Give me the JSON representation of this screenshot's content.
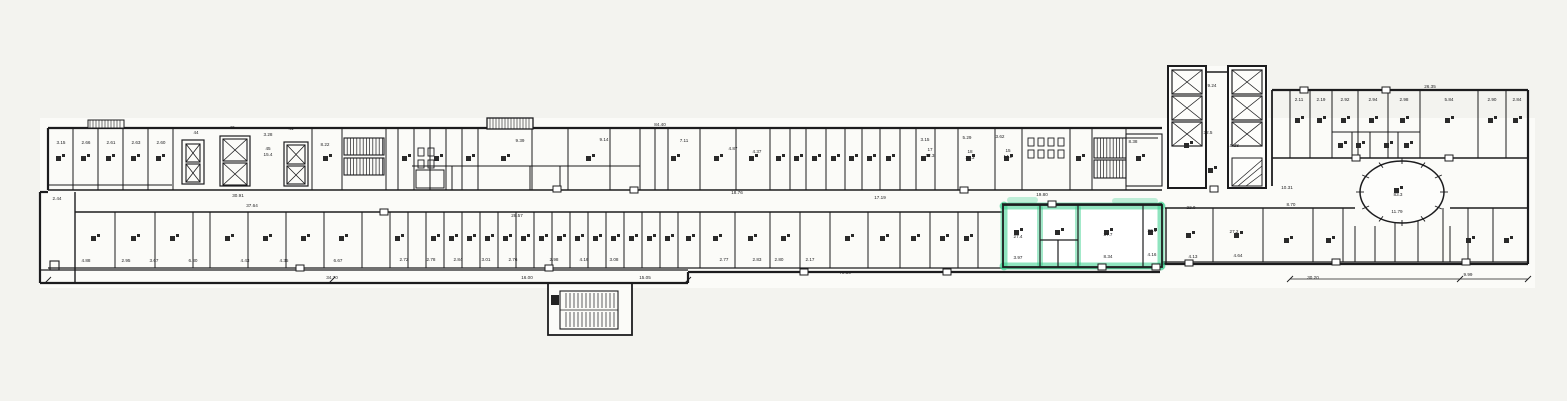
{
  "title": {
    "floor": "2 этаж",
    "address": "Правды ул., д.24, стр.4"
  },
  "highlight_color": "#35cf8c",
  "ink_color": "#1c1c1e",
  "labels": [
    {
      "t": "2.44",
      "x": 57,
      "y": 200
    },
    {
      "t": "3.15",
      "x": 61,
      "y": 144
    },
    {
      "t": "2.66",
      "x": 86,
      "y": 144
    },
    {
      "t": "2.61",
      "x": 111,
      "y": 144
    },
    {
      "t": "2.63",
      "x": 136,
      "y": 144
    },
    {
      "t": "2.60",
      "x": 161,
      "y": 144
    },
    {
      "t": "44",
      "x": 196,
      "y": 134
    },
    {
      "t": "42",
      "x": 232,
      "y": 129
    },
    {
      "t": "3.28",
      "x": 268,
      "y": 136
    },
    {
      "t": "41",
      "x": 291,
      "y": 130
    },
    {
      "t": "45",
      "x": 268,
      "y": 150
    },
    {
      "t": "15.4",
      "x": 268,
      "y": 156
    },
    {
      "t": "8.22",
      "x": 325,
      "y": 146
    },
    {
      "t": "30.91",
      "x": 238,
      "y": 197
    },
    {
      "t": "37.64",
      "x": 252,
      "y": 207
    },
    {
      "t": "9.39",
      "x": 520,
      "y": 142
    },
    {
      "t": "9.14",
      "x": 604,
      "y": 141
    },
    {
      "t": "7.11",
      "x": 684,
      "y": 142
    },
    {
      "t": "4.87",
      "x": 733,
      "y": 150
    },
    {
      "t": "4.37",
      "x": 757,
      "y": 153
    },
    {
      "t": "84.40",
      "x": 660,
      "y": 126
    },
    {
      "t": "3.15",
      "x": 925,
      "y": 141
    },
    {
      "t": "5.29",
      "x": 967,
      "y": 139
    },
    {
      "t": "3.62",
      "x": 1000,
      "y": 138
    },
    {
      "t": "17",
      "x": 930,
      "y": 151
    },
    {
      "t": "12.3",
      "x": 930,
      "y": 157
    },
    {
      "t": "18",
      "x": 970,
      "y": 153
    },
    {
      "t": "20.3",
      "x": 970,
      "y": 159
    },
    {
      "t": "15",
      "x": 1008,
      "y": 152
    },
    {
      "t": "14.2",
      "x": 1008,
      "y": 158
    },
    {
      "t": "8.38",
      "x": 1133,
      "y": 143
    },
    {
      "t": "28.57",
      "x": 517,
      "y": 217
    },
    {
      "t": "18.76",
      "x": 737,
      "y": 194
    },
    {
      "t": "17.19",
      "x": 880,
      "y": 199
    },
    {
      "t": "19.80",
      "x": 1042,
      "y": 196
    },
    {
      "t": "9.24",
      "x": 1212,
      "y": 87
    },
    {
      "t": "32.5",
      "x": 1208,
      "y": 134
    },
    {
      "t": "10.38",
      "x": 1233,
      "y": 147
    },
    {
      "t": "26.35",
      "x": 1430,
      "y": 88
    },
    {
      "t": "2.11",
      "x": 1299,
      "y": 101
    },
    {
      "t": "2.19",
      "x": 1321,
      "y": 101
    },
    {
      "t": "2.92",
      "x": 1345,
      "y": 101
    },
    {
      "t": "2.94",
      "x": 1373,
      "y": 101
    },
    {
      "t": "2.98",
      "x": 1404,
      "y": 101
    },
    {
      "t": "5.84",
      "x": 1449,
      "y": 101
    },
    {
      "t": "2.90",
      "x": 1492,
      "y": 101
    },
    {
      "t": "2.84",
      "x": 1517,
      "y": 101
    },
    {
      "t": "10.31",
      "x": 1287,
      "y": 189
    },
    {
      "t": "8.70",
      "x": 1291,
      "y": 206
    },
    {
      "t": "83.3",
      "x": 1398,
      "y": 196
    },
    {
      "t": "11.79",
      "x": 1397,
      "y": 213
    },
    {
      "t": "27.4",
      "x": 1018,
      "y": 238
    },
    {
      "t": "37.7",
      "x": 1108,
      "y": 236
    },
    {
      "t": "22.1",
      "x": 1152,
      "y": 232
    },
    {
      "t": "3.97",
      "x": 1018,
      "y": 259
    },
    {
      "t": "8.34",
      "x": 1108,
      "y": 258
    },
    {
      "t": "4.16",
      "x": 1152,
      "y": 256
    },
    {
      "t": "22.0",
      "x": 1191,
      "y": 209
    },
    {
      "t": "27.2",
      "x": 1234,
      "y": 233
    },
    {
      "t": "4.13",
      "x": 1193,
      "y": 258
    },
    {
      "t": "4.64",
      "x": 1238,
      "y": 257
    },
    {
      "t": "4.88",
      "x": 86,
      "y": 262
    },
    {
      "t": "2.95",
      "x": 126,
      "y": 262
    },
    {
      "t": "3.67",
      "x": 154,
      "y": 262
    },
    {
      "t": "6.80",
      "x": 193,
      "y": 262
    },
    {
      "t": "4.43",
      "x": 245,
      "y": 262
    },
    {
      "t": "4.35",
      "x": 284,
      "y": 262
    },
    {
      "t": "6.67",
      "x": 338,
      "y": 262
    },
    {
      "t": "2.72",
      "x": 404,
      "y": 261
    },
    {
      "t": "2.78",
      "x": 431,
      "y": 261
    },
    {
      "t": "2.84",
      "x": 458,
      "y": 261
    },
    {
      "t": "3.01",
      "x": 486,
      "y": 261
    },
    {
      "t": "2.76",
      "x": 513,
      "y": 261
    },
    {
      "t": "2.98",
      "x": 554,
      "y": 261
    },
    {
      "t": "4.16",
      "x": 584,
      "y": 261
    },
    {
      "t": "3.08",
      "x": 614,
      "y": 261
    },
    {
      "t": "2.77",
      "x": 724,
      "y": 261
    },
    {
      "t": "2.83",
      "x": 757,
      "y": 261
    },
    {
      "t": "2.80",
      "x": 779,
      "y": 261
    },
    {
      "t": "2.17",
      "x": 810,
      "y": 261
    },
    {
      "t": "34.70",
      "x": 332,
      "y": 279
    },
    {
      "t": "16.00",
      "x": 527,
      "y": 279
    },
    {
      "t": "15.05",
      "x": 645,
      "y": 279
    },
    {
      "t": "70.36",
      "x": 845,
      "y": 274
    },
    {
      "t": "30.20",
      "x": 1313,
      "y": 279
    },
    {
      "t": "9.99",
      "x": 1468,
      "y": 276
    }
  ]
}
